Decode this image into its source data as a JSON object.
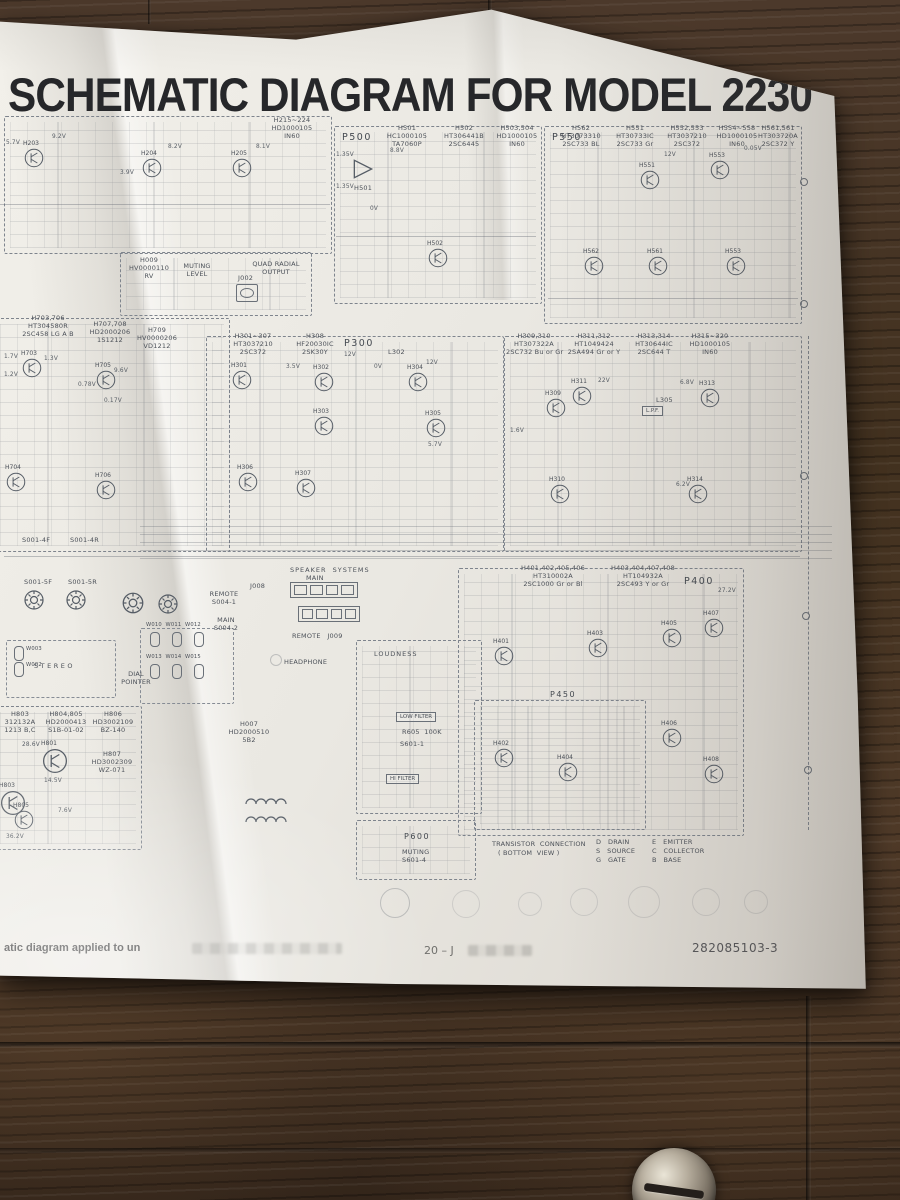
{
  "colors": {
    "paper": "#eae8e2",
    "wood": "#46342a",
    "title_ink": "#26272a",
    "trace_ink": "#565d66"
  },
  "title": "SCHEMATIC DIAGRAM FOR MODEL 2230",
  "blocks": {
    "tuner": {
      "header": [
        "H215~224",
        "HD1000105",
        "IN60"
      ],
      "q": [
        "H203",
        "H204",
        "H205"
      ],
      "v": [
        "5.7V",
        "9.2V",
        "8.2V",
        "8.1V",
        "3.9V"
      ]
    },
    "muting": {
      "part": [
        "H009",
        "HV0000110",
        "RV"
      ],
      "label": [
        "MUTING",
        "LEVEL"
      ],
      "jack": "J002",
      "out": [
        "QUAD RADIAL",
        "OUTPUT"
      ]
    },
    "p500": {
      "name": "P500",
      "cols": [
        [
          "H501",
          "HC1000105",
          "TA7060P"
        ],
        [
          "H502",
          "HT306441B",
          "2SC6445"
        ],
        [
          "H503,504",
          "HD1000105",
          "IN60"
        ]
      ],
      "q": [
        "H501",
        "H502"
      ],
      "v": [
        "1.35V",
        "8.8V",
        "1.35V",
        "0V"
      ]
    },
    "p550": {
      "name": "P550",
      "cols": [
        [
          "H562",
          "HT3073310",
          "2SC733 BL"
        ],
        [
          "H551",
          "HT30733IC",
          "2SC733 Gr"
        ],
        [
          "H552,553",
          "HT3037210",
          "2SC372"
        ],
        [
          "H554~558",
          "HD1000105",
          "IN60"
        ],
        [
          "H561,561",
          "HT303720A",
          "2SC372 Y"
        ]
      ],
      "q": [
        "H551",
        "H553",
        "H562",
        "H561",
        "H553"
      ],
      "v": [
        "12V",
        "0.05V"
      ]
    },
    "ifamp": {
      "cols": [
        [
          "H703,706",
          "HT304580R",
          "2SC458 LG A B"
        ],
        [
          "H707,708",
          "HD2000206",
          "1S1212"
        ],
        [
          "H709",
          "HV0000206",
          "VD1212"
        ]
      ],
      "q": [
        "H703",
        "H705",
        "H704",
        "H706"
      ],
      "v": [
        "1.7V",
        "1.3V",
        "1.2V",
        "9.6V",
        "0.78V",
        "0.17V"
      ]
    },
    "p300": {
      "name": "P300",
      "cols": [
        [
          "H301~307",
          "HT3037210",
          "2SC372"
        ],
        [
          "H308",
          "HF20030IC",
          "2SK30Y"
        ]
      ],
      "coil": "L302",
      "q": [
        "H301",
        "H302",
        "H303",
        "H304",
        "H305",
        "H306",
        "H307"
      ],
      "v": [
        "12V",
        "3.5V",
        "12V",
        "0V",
        "5.7V"
      ]
    },
    "mpx": {
      "cols": [
        [
          "H309,310",
          "HT307322A",
          "2SC732 Bu or Gr"
        ],
        [
          "H311,312",
          "HT1049424",
          "2SA494 Gr or Y"
        ],
        [
          "H313,314",
          "HT30644IC",
          "2SC644 T"
        ],
        [
          "H315~320",
          "HD1000105",
          "IN60"
        ]
      ],
      "coil": "L305",
      "lpf": "L.P.F.",
      "q": [
        "H309",
        "H311",
        "H313",
        "H310",
        "H314"
      ],
      "v": [
        "22V",
        "6.8V",
        "6.2V",
        "1.6V"
      ]
    },
    "speaker": {
      "title": "SPEAKER  SYSTEMS",
      "main": "MAIN",
      "j1": "J008",
      "remote": "REMOTE   J009"
    },
    "panel": {
      "sw": [
        "S001-4F",
        "S001-4R",
        "S001-5F",
        "S001-5R"
      ],
      "stereo": "STEREO",
      "remote": [
        "REMOTE",
        "S004-1"
      ],
      "main": [
        "MAIN",
        "S004-2"
      ],
      "dial": [
        "DIAL",
        "POINTER"
      ],
      "lamps_top": "W010  W011  W012",
      "lamps_bot": "W013  W014  W015",
      "lamps_left": [
        "W003",
        "W002"
      ]
    },
    "filters": {
      "loudness": "LOUDNESS",
      "low": "LOW  FILTER",
      "r605": "R605  100K",
      "s1": "S601-1",
      "hi": "HI  FILTER"
    },
    "headphone": {
      "label": "HEADPHONE",
      "part": [
        "H007",
        "HD2000510",
        "5B2"
      ]
    },
    "p400": {
      "name": "P400",
      "sub": "P450",
      "volt": "27.2V",
      "cols": [
        [
          "H401,402,405,406",
          "HT310002A",
          "2SC1000 Gr or Bl"
        ],
        [
          "H403,404,407,408",
          "HT104932A",
          "2SC493 Y or Gr"
        ]
      ],
      "q": [
        "H401",
        "H403",
        "H405",
        "H407",
        "H402",
        "H404",
        "H406",
        "H408"
      ]
    },
    "power": {
      "cols": [
        [
          "H803",
          "312132A",
          "1213 B,C"
        ],
        [
          "H804,805",
          "HD2000413",
          "S1B-01-02"
        ],
        [
          "H806",
          "HD3002109",
          "BZ-140"
        ],
        [
          "H807",
          "HD3002309",
          "WZ-071"
        ]
      ],
      "q": [
        "H801",
        "H803",
        "H805"
      ],
      "v": [
        "28.6V",
        "14.5V",
        "7.6V",
        "36.2V"
      ]
    },
    "p600": {
      "name": "P600",
      "label": "MUTING",
      "sw": "S601-4"
    }
  },
  "legend": {
    "title": "TRANSISTOR  CONNECTION",
    "subtitle": "( BOTTOM  VIEW )",
    "pins": [
      "D   DRAIN",
      "S   SOURCE",
      "G   GATE",
      "E   EMITTER",
      "C   COLLECTOR",
      "B   BASE"
    ]
  },
  "footer": {
    "left": "atic diagram applied to un",
    "center": "20 – J",
    "right": "282085103-3"
  }
}
